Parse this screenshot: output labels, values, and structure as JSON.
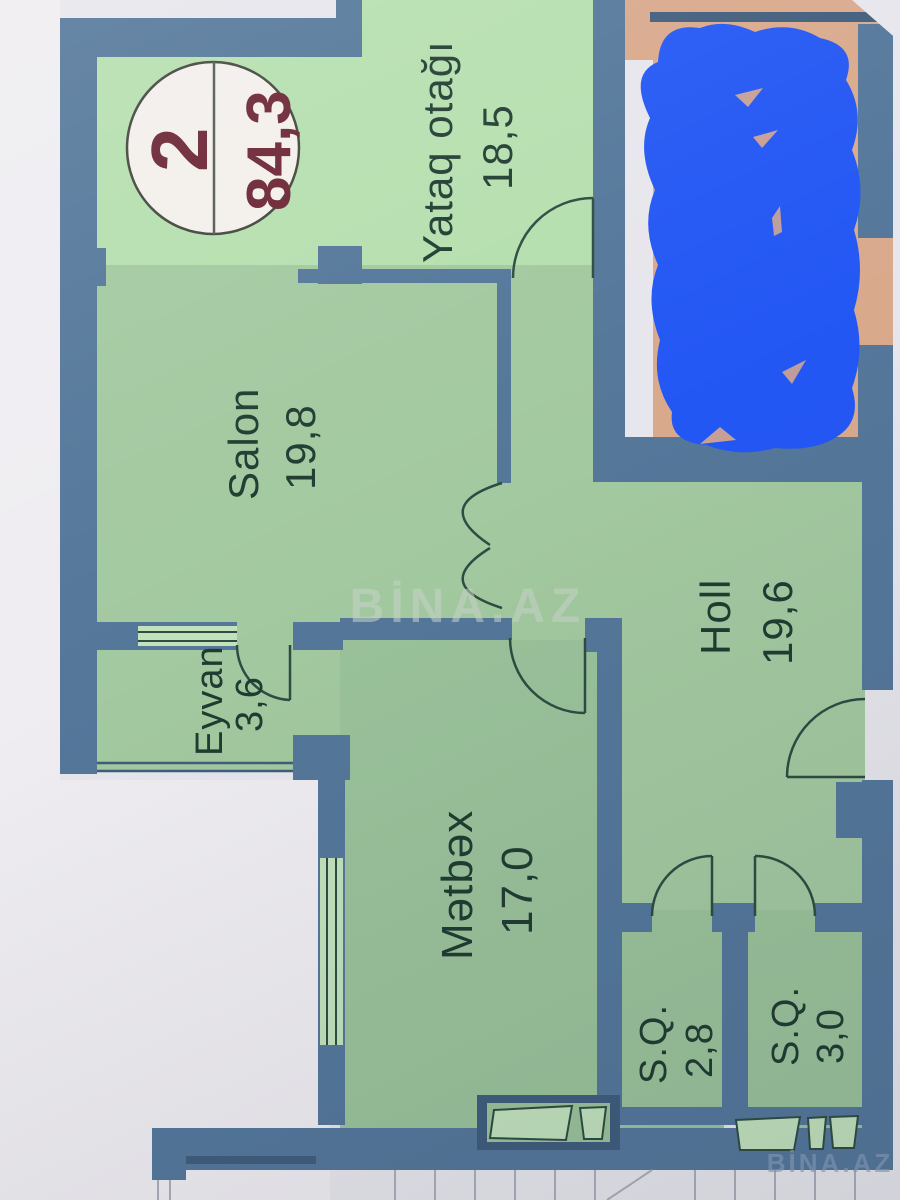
{
  "badge": {
    "unit_number": "2",
    "total_area_m2": "84,3"
  },
  "rooms": [
    {
      "id": "yataq-otagi",
      "name": "Yataq otağı",
      "area": "18,5"
    },
    {
      "id": "salon",
      "name": "Salon",
      "area": "19,8"
    },
    {
      "id": "holl",
      "name": "Holl",
      "area": "19,6"
    },
    {
      "id": "eyvan",
      "name": "Eyvan",
      "area": "3,6"
    },
    {
      "id": "metbex",
      "name": "Mətbəx",
      "area": "17,0"
    },
    {
      "id": "sanqovshaq-1",
      "name": "S.Q.",
      "area": "2,8"
    },
    {
      "id": "sanqovshaq-2",
      "name": "S.Q.",
      "area": "3,0"
    }
  ],
  "watermarks": {
    "center": "BİNA.AZ",
    "corner": "BİNA.AZ"
  },
  "colors": {
    "paper": "#e7e6ec",
    "paper_bright": "#efedf1",
    "wall": "#54779a",
    "wall_dark": "#3f5d7c",
    "line": "#2e4c42",
    "room_green": "#a3c9a0",
    "room_green_bright": "#b5dfae",
    "room_green_dim": "#9ac29a",
    "glazing_green": "#c2e2bc",
    "tan": "#d9a98c",
    "scribble": "#2357f4",
    "label": "#203c31",
    "badge_bg": "#f3efeb",
    "badge_text": "#6b2433",
    "watermark_center": "#c9d4c9",
    "watermark_corner": "#8aa0bf",
    "stair_line": "#a9aeb9"
  }
}
